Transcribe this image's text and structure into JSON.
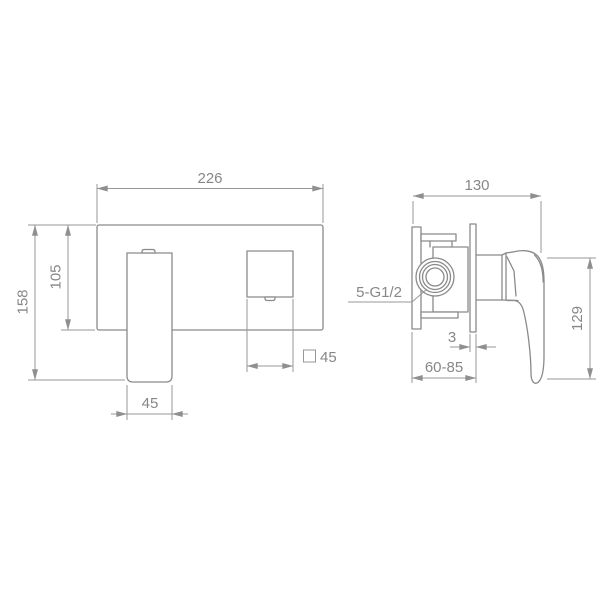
{
  "front_view": {
    "dims": {
      "width": "226",
      "overall_height": "158",
      "plate_height": "105",
      "spout_width": "45",
      "handle_size": "45"
    }
  },
  "side_view": {
    "dims": {
      "width": "130",
      "height": "129",
      "wall_plate_thickness": "3",
      "installation_depth": "60-85",
      "connection": "5-G1/2"
    }
  },
  "colors": {
    "line": "#8a8a8a",
    "text": "#878787",
    "background": "#ffffff"
  }
}
